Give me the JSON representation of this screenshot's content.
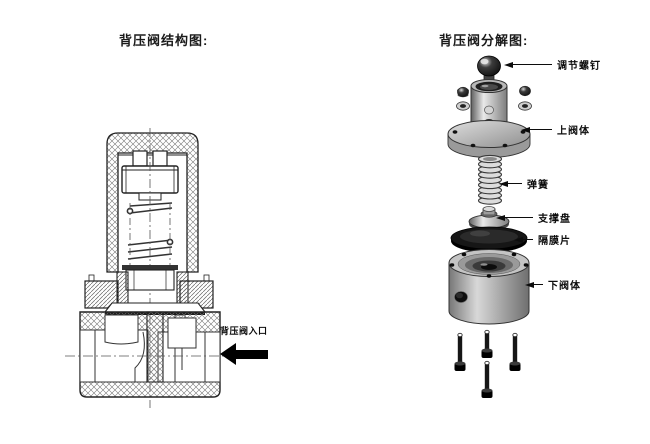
{
  "figures": {
    "left": {
      "title": "背压阀结构图:",
      "inlet_label": "背压阀入口"
    },
    "right": {
      "title": "背压阀分解图:",
      "parts": [
        {
          "id": "adjust-screw",
          "label": "调节螺钉"
        },
        {
          "id": "upper-valve-body",
          "label": "上阀体"
        },
        {
          "id": "spring",
          "label": "弹簧"
        },
        {
          "id": "support-plate",
          "label": "支撑盘"
        },
        {
          "id": "diaphragm",
          "label": "隔膜片"
        },
        {
          "id": "lower-valve-body",
          "label": "下阀体"
        }
      ]
    }
  },
  "colors": {
    "background": "#ffffff",
    "line": "#222222",
    "label_text": "#0c0c0c",
    "arrow_fill": "#000000",
    "metal_dark": "#111111",
    "metal_mid": "#9a9a9a",
    "metal_light": "#e9e9e9"
  }
}
